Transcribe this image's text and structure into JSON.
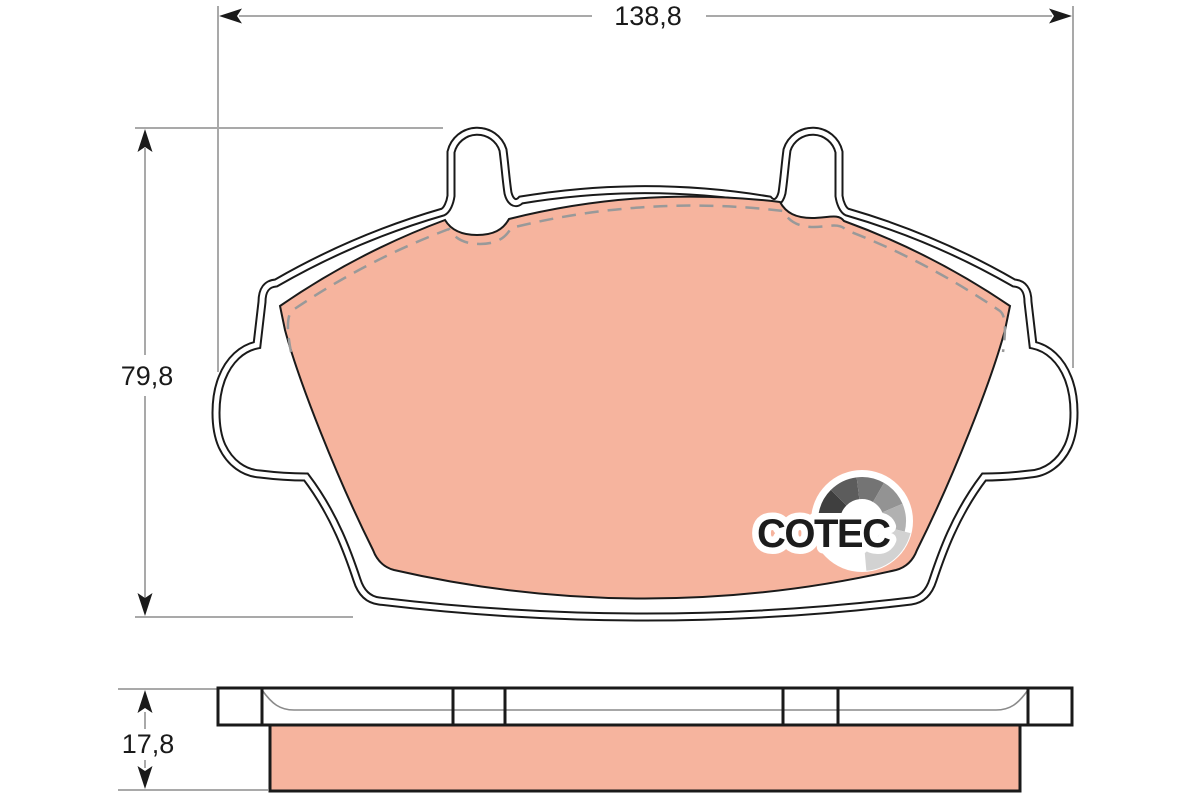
{
  "dimensions": {
    "width_label": "138,8",
    "height_label": "79,8",
    "thickness_label": "17,8"
  },
  "logo": {
    "text": "COTEC",
    "gauge": {
      "cx": 862,
      "cy": 521,
      "inner_radius": 22,
      "white_radius": 51,
      "segments": [
        {
          "from": 215,
          "to": 175,
          "r": 44,
          "color": "#161616"
        },
        {
          "from": 175,
          "to": 135,
          "r": 44,
          "color": "#3f3f3f"
        },
        {
          "from": 135,
          "to": 97,
          "r": 44,
          "color": "#5c5c5c"
        },
        {
          "from": 97,
          "to": 60,
          "r": 44,
          "color": "#747474"
        },
        {
          "from": 60,
          "to": 23,
          "r": 44,
          "color": "#939393"
        },
        {
          "from": 23,
          "to": -14,
          "r": 44,
          "color": "#b1b1b1"
        },
        {
          "from": -14,
          "to": -85,
          "r": 50,
          "color": "#d2d2d2"
        }
      ]
    }
  },
  "colors": {
    "background": "#ffffff",
    "friction_material": "#f6b49e",
    "outline": "#1a1a1a",
    "dimension_line": "#a9a9a9",
    "dashed_line": "#999999",
    "logo_text": "#1c1c1c",
    "logo_background": "#ffffff"
  }
}
